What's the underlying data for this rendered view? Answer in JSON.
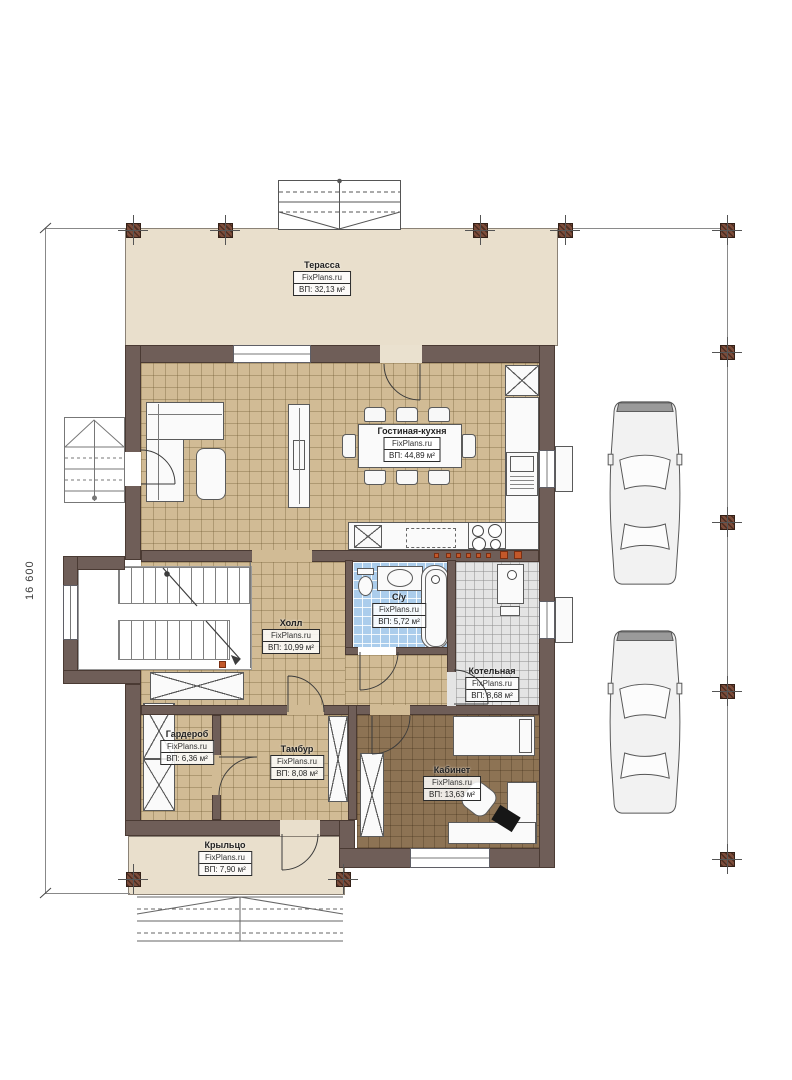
{
  "plan": {
    "dimension_left": "16 600",
    "rooms": {
      "terrace": {
        "name": "Терасса",
        "brand": "FixPlans.ru",
        "area": "ВП: 32,13 м²"
      },
      "living": {
        "name": "Гостиная-кухня",
        "brand": "FixPlans.ru",
        "area": "ВП: 44,89 м²"
      },
      "bathroom": {
        "name": "С/у",
        "brand": "FixPlans.ru",
        "area": "ВП: 5,72 м²"
      },
      "hall": {
        "name": "Холл",
        "brand": "FixPlans.ru",
        "area": "ВП: 10,99 м²"
      },
      "boiler": {
        "name": "Котельная",
        "brand": "FixPlans.ru",
        "area": "ВП: 8,68 м²"
      },
      "wardrobe": {
        "name": "Гардероб",
        "brand": "FixPlans.ru",
        "area": "ВП: 6,36 м²"
      },
      "tambour": {
        "name": "Тамбур",
        "brand": "FixPlans.ru",
        "area": "ВП: 8,08 м²"
      },
      "office": {
        "name": "Кабинет",
        "brand": "FixPlans.ru",
        "area": "ВП: 13,63 м²"
      },
      "porch": {
        "name": "Крыльцо",
        "brand": "FixPlans.ru",
        "area": "ВП: 7,90 м²"
      }
    },
    "colors": {
      "wall": "#6f5e58",
      "floor_tile": "#d1bb95",
      "bath_tile": "#abcdec",
      "boiler_tile": "#e4e4e4",
      "office_floor": "#8d7354",
      "deck": "#e9dfcc",
      "accent": "#c3582a"
    }
  }
}
